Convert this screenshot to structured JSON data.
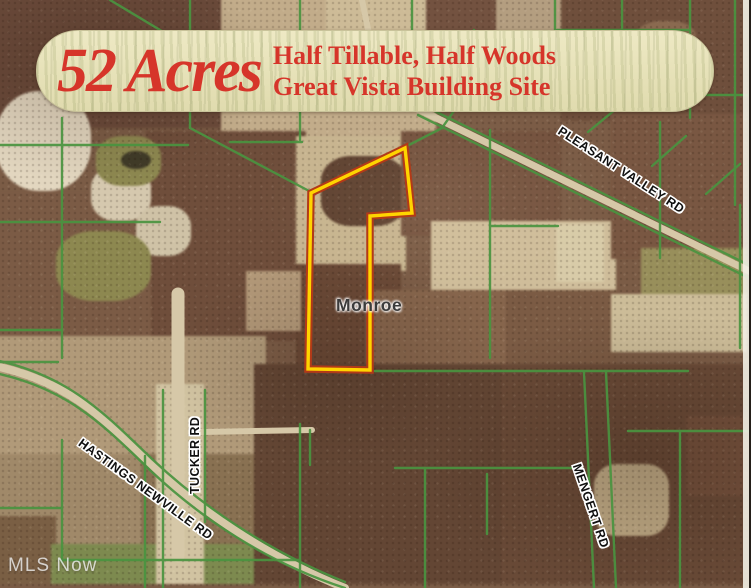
{
  "listing": {
    "acreage_headline": "52 Acres",
    "feature_line1": "Half Tillable, Half Woods",
    "feature_line2": "Great Vista Building Site",
    "text_color": "#d6352a",
    "banner_bg": "#e9e5bc"
  },
  "map": {
    "township_label": "Monroe",
    "roads": [
      {
        "name": "PLEASANT VALLEY RD"
      },
      {
        "name": "HASTINGS NEWVILLE RD"
      },
      {
        "name": "TUCKER RD"
      },
      {
        "name": "MENGERT RD"
      }
    ],
    "property_outline": {
      "inner_color": "#ffd400",
      "outer_color": "#b23a18"
    },
    "parcel_line_color": "#4a9440",
    "road_fill_color": "#d6c8a8"
  },
  "watermark": {
    "label": "MLS Now"
  }
}
